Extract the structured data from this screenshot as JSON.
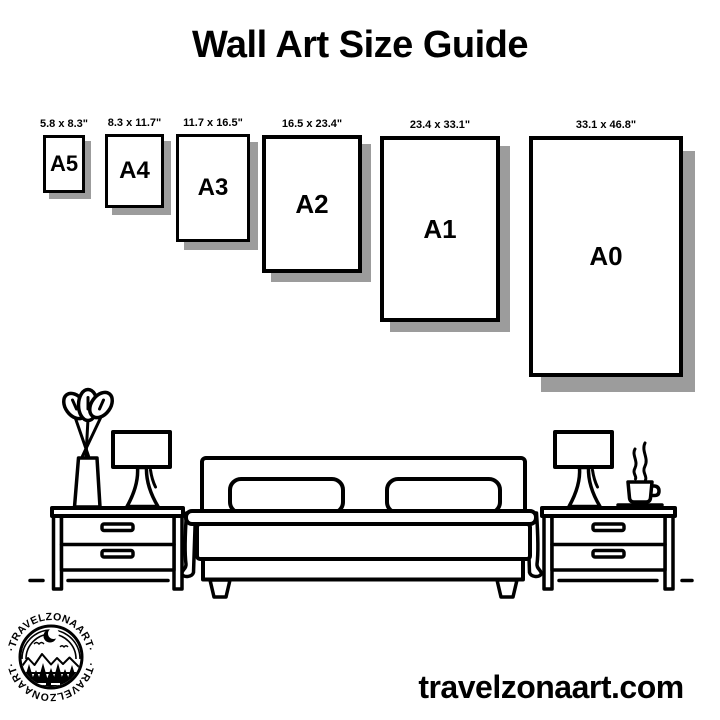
{
  "title": "Wall Art Size Guide",
  "papers": [
    {
      "name": "A5",
      "dim": "5.8 x 8.3\""
    },
    {
      "name": "A4",
      "dim": "8.3 x 11.7\""
    },
    {
      "name": "A3",
      "dim": "11.7 x 16.5\""
    },
    {
      "name": "A2",
      "dim": "16.5 x 23.4\""
    },
    {
      "name": "A1",
      "dim": "23.4 x 33.1\""
    },
    {
      "name": "A0",
      "dim": "33.1 x 46.8\""
    }
  ],
  "logo": {
    "ring_text_top": "·TRAVELZONAART·",
    "ring_text_bottom": "·TRAVELZONAART·"
  },
  "footer": {
    "website": "travelzonaart.com"
  },
  "colors": {
    "ink": "#000000",
    "paper_shadow": "#9c9c9c",
    "background": "#ffffff"
  },
  "illustration": {
    "icons": [
      "plant-icon",
      "table-lamp-left-icon",
      "nightstand-left-icon",
      "bed-icon",
      "nightstand-right-icon",
      "table-lamp-right-icon",
      "coffee-cup-icon",
      "floor-line",
      "brand-logo"
    ]
  }
}
